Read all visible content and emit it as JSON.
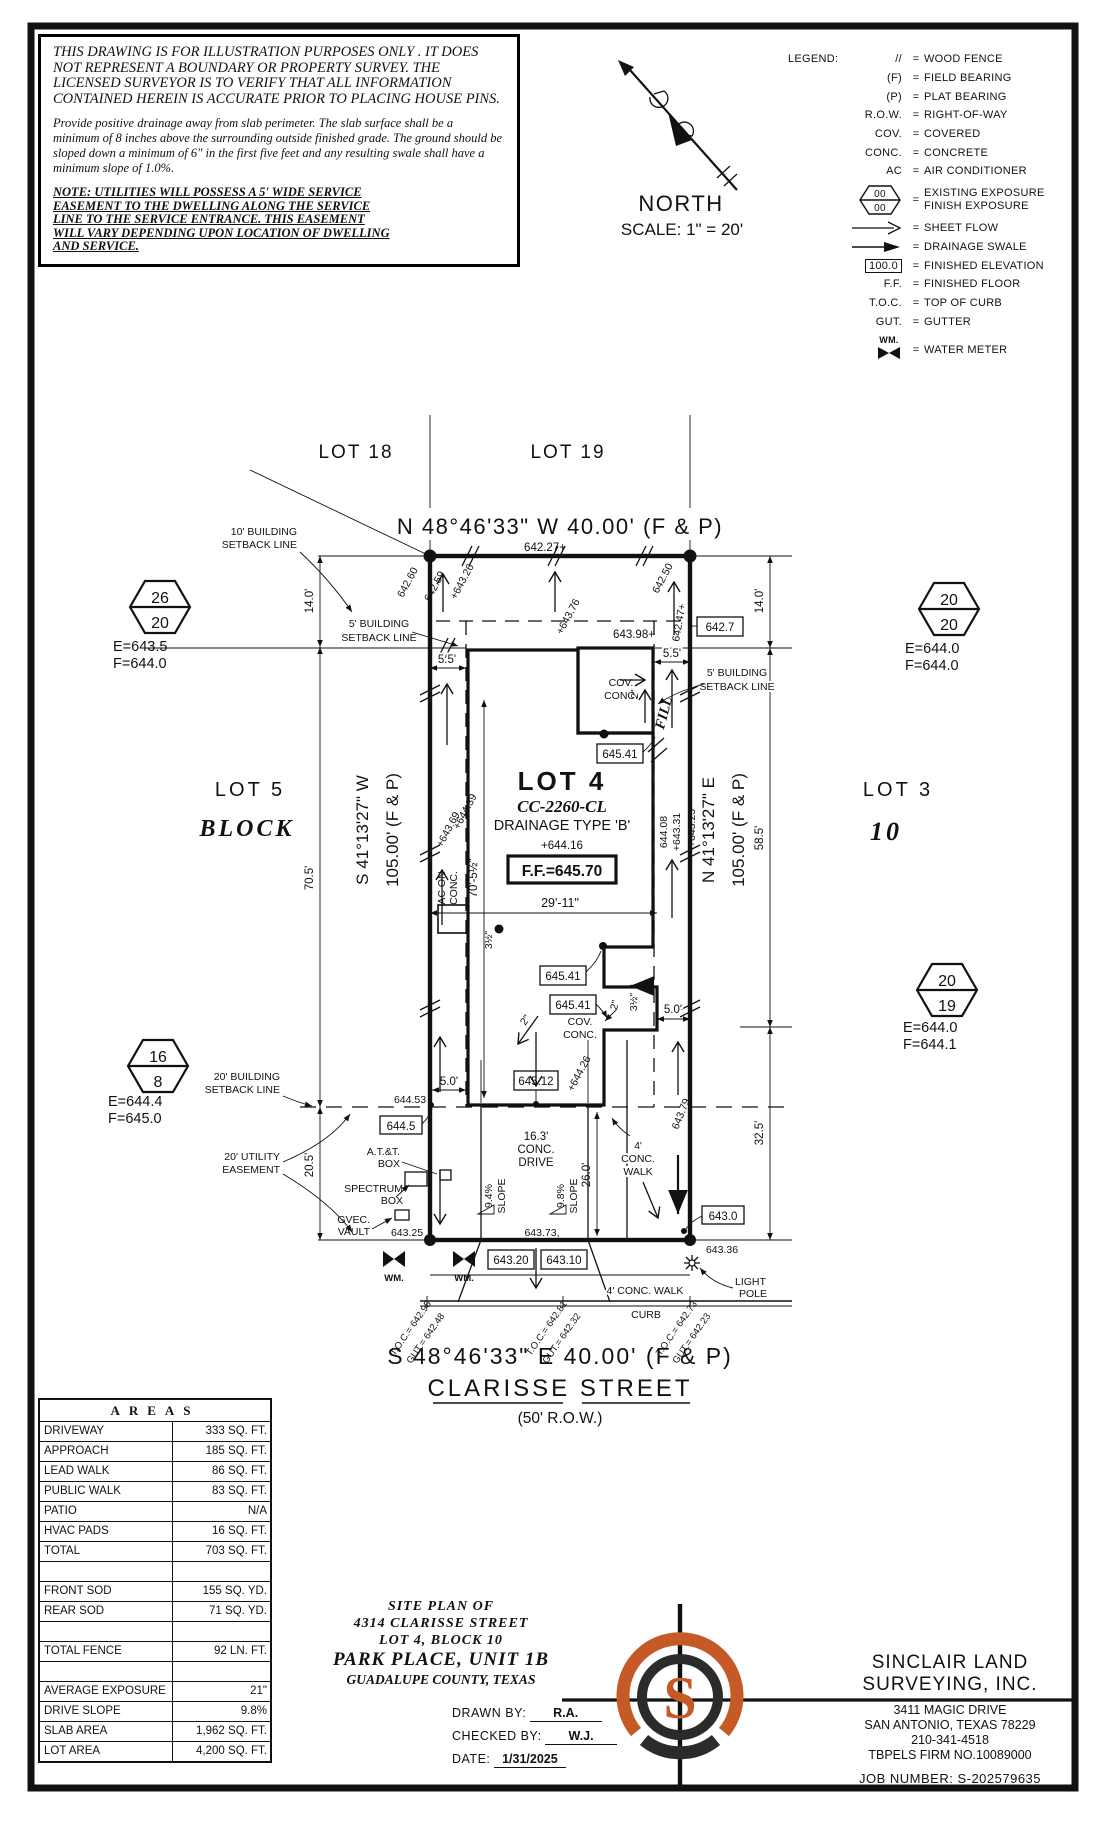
{
  "disclaimer": {
    "p1": [
      "THIS DRAWING IS FOR ILLUSTRATION PURPOSES ONLY . IT DOES",
      "NOT REPRESENT A BOUNDARY OR PROPERTY SURVEY. THE",
      "LICENSED SURVEYOR IS TO VERIFY THAT ALL INFORMATION",
      "CONTAINED HEREIN IS ACCURATE PRIOR TO PLACING HOUSE PINS."
    ],
    "p2": [
      "Provide positive drainage away from slab perimeter. The slab surface shall be a",
      "minimum of 8 inches above the surrounding outside finished grade. The ground should be",
      "sloped down a minimum of 6\" in the first five feet and any resulting swale shall have a",
      "minimum slope of 1.0%."
    ],
    "note": [
      "NOTE: UTILITIES WILL POSSESS A 5' WIDE SERVICE",
      "EASEMENT TO THE DWELLING ALONG THE SERVICE",
      "LINE TO THE SERVICE ENTRANCE. THIS EASEMENT",
      "WILL VARY DEPENDING UPON LOCATION OF DWELLING",
      "AND SERVICE."
    ]
  },
  "north": {
    "label": "NORTH",
    "scale": "SCALE:  1\" = 20'"
  },
  "legend": {
    "title": "LEGEND:",
    "eq": "=",
    "hex_top": "00",
    "hex_bottom": "00",
    "box_val": "100.0",
    "wm": "WM.",
    "rows": [
      {
        "s": "//",
        "d": "WOOD FENCE"
      },
      {
        "s": "(F)",
        "d": "FIELD BEARING"
      },
      {
        "s": "(P)",
        "d": "PLAT BEARING"
      },
      {
        "s": "R.O.W.",
        "d": "RIGHT-OF-WAY"
      },
      {
        "s": "COV.",
        "d": "COVERED"
      },
      {
        "s": "CONC.",
        "d": "CONCRETE"
      },
      {
        "s": "AC",
        "d": "AIR CONDITIONER"
      },
      {
        "d1": "EXISTING EXPOSURE",
        "d2": "FINISH EXPOSURE"
      },
      {
        "d": "SHEET FLOW"
      },
      {
        "d": "DRAINAGE SWALE"
      },
      {
        "d": "FINISHED ELEVATION"
      },
      {
        "s": "F.F.",
        "d": "FINISHED FLOOR"
      },
      {
        "s": "T.O.C.",
        "d": "TOP OF CURB"
      },
      {
        "s": "GUT.",
        "d": "GUTTER"
      },
      {
        "d": "WATER METER"
      }
    ]
  },
  "plan": {
    "lot18": "LOT 18",
    "lot19": "LOT 19",
    "lot5": "LOT 5",
    "lot3": "LOT 3",
    "block_word": "BLOCK",
    "block_num": "10",
    "brg_top": "N 48°46'33\" W  40.00'  (F & P)",
    "brg_bottom": "S 48°46'33\" E  40.00'  (F & P)",
    "street": "CLARISSE STREET",
    "row": "(50' R.O.W.)",
    "brg_left_dir": "S 41°13'27\" W",
    "brg_left_len": "105.00' (F & P)",
    "brg_right_dir": "N 41°13'27\" E",
    "brg_right_len": "105.00' (F & P)",
    "sb10_1": "10' BUILDING",
    "sb10_2": "SETBACK LINE",
    "sb5_1": "5' BUILDING",
    "sb5_2": "SETBACK LINE",
    "sb20_1": "20' BUILDING",
    "sb20_2": "SETBACK LINE",
    "ue_1": "20' UTILITY",
    "ue_2": "EASEMENT",
    "lot4": "LOT 4",
    "plan_id": "CC-2260-CL",
    "drainage": "DRAINAGE TYPE 'B'",
    "ff": "F.F.=645.70",
    "ff_pad": "+644.16",
    "d14": "14.0'",
    "d70": "70.5'",
    "d205": "20.5'",
    "d585": "58.5'",
    "d325": "32.5'",
    "d55": "5.5'",
    "d50": "5.0'",
    "d29": "29'-11\"",
    "d705": "70'-5½\"",
    "d26": "26.0'",
    "drive1": "16.3'",
    "drive2": "CONC.",
    "drive3": "DRIVE",
    "walk1": "4'",
    "walk2": "CONC.",
    "walk3": "WALK",
    "walk_s": "4' CONC. WALK",
    "curb": "CURB",
    "cov": "COV.",
    "conc": "CONC.",
    "fill": "FILL",
    "ac1": "AC ON",
    "ac2": "CONC.",
    "in2": "2\"",
    "in35": "3½\"",
    "slope94": "9.4%",
    "slope98": "9.8%",
    "slope_word": "SLOPE",
    "att1": "A.T.&T.",
    "att2": "BOX",
    "spec1": "SPECTRUM",
    "spec2": "BOX",
    "gvec1": "GVEC.",
    "gvec2": "VAULT",
    "wm": "WM.",
    "light1": "LIGHT",
    "light2": "POLE",
    "elev": {
      "a1": "642.60",
      "a2": "642.59",
      "a3": "+643.26",
      "a4": "642.27+",
      "a5": "+643.76",
      "a6": "643.98+",
      "a7": "642.50",
      "a8": "642.47+",
      "a9": "642.7",
      "b1": "+643.69",
      "b2": "+644.39",
      "b3": "644.08",
      "b4": "+643.31",
      "b5": "+643.25",
      "c1": "645.41",
      "c2": "645.12",
      "c3": "+644.26",
      "c4": "644.53",
      "c5": "644.5",
      "c6": "643.79",
      "c7": "643.25",
      "c8": "643.73,",
      "c9": "643.0",
      "c10": "643.36",
      "c11": "643.20",
      "c12": "643.10"
    },
    "toc": [
      {
        "t": "T.O.C.= 642.95",
        "g": "GUT.= 642.48"
      },
      {
        "t": "T.O.C.= 642.81",
        "g": "GUT.= 642.32"
      },
      {
        "t": "T.O.C.= 642.73",
        "g": "GUT.= 642.23"
      }
    ],
    "hex": [
      {
        "top": "26",
        "bottom": "20",
        "e": "E=643.5",
        "f": "F=644.0"
      },
      {
        "top": "20",
        "bottom": "20",
        "e": "E=644.0",
        "f": "F=644.0"
      },
      {
        "top": "16",
        "bottom": "8",
        "e": "E=644.4",
        "f": "F=645.0"
      },
      {
        "top": "20",
        "bottom": "19",
        "e": "E=644.0",
        "f": "F=644.1"
      }
    ]
  },
  "areas": {
    "title": "AREAS",
    "rows": [
      {
        "l": "DRIVEWAY",
        "v": "333 SQ. FT."
      },
      {
        "l": "APPROACH",
        "v": "185 SQ. FT."
      },
      {
        "l": "LEAD WALK",
        "v": "86 SQ. FT."
      },
      {
        "l": "PUBLIC WALK",
        "v": "83 SQ. FT."
      },
      {
        "l": "PATIO",
        "v": "N/A"
      },
      {
        "l": "HVAC PADS",
        "v": "16 SQ. FT."
      },
      {
        "l": "TOTAL",
        "v": "703 SQ. FT."
      },
      {
        "l": "",
        "v": ""
      },
      {
        "l": "FRONT SOD",
        "v": "155 SQ. YD."
      },
      {
        "l": "REAR SOD",
        "v": "71 SQ. YD."
      },
      {
        "l": "",
        "v": ""
      },
      {
        "l": "TOTAL FENCE",
        "v": "92 LN. FT."
      },
      {
        "l": "",
        "v": ""
      },
      {
        "l": "AVERAGE EXPOSURE",
        "v": "21\""
      },
      {
        "l": "DRIVE SLOPE",
        "v": "9.8%"
      },
      {
        "l": "SLAB AREA",
        "v": "1,962 SQ. FT."
      },
      {
        "l": "LOT AREA",
        "v": "4,200 SQ. FT."
      }
    ]
  },
  "title_block": {
    "line1": "SITE PLAN OF",
    "line2": "4314 CLARISSE STREET",
    "line3": "LOT 4, BLOCK 10",
    "line4": "PARK PLACE, UNIT 1B",
    "line5": "GUADALUPE COUNTY, TEXAS",
    "drawn_label": "DRAWN BY:",
    "drawn": "R.A.",
    "checked_label": "CHECKED BY:",
    "checked": "W.J.",
    "date_label": "DATE:",
    "date": "1/31/2025"
  },
  "surveyor": {
    "name1": "SINCLAIR LAND",
    "name2": "SURVEYING, INC.",
    "addr1": "3411 MAGIC DRIVE",
    "addr2": "SAN ANTONIO, TEXAS 78229",
    "phone": "210-341-4518",
    "firm": "TBPELS FIRM NO.10089000",
    "job": "JOB NUMBER:  S-202579635",
    "logo_letter": "S"
  },
  "colors": {
    "accent": "#c65a27",
    "ink": "#111111"
  }
}
